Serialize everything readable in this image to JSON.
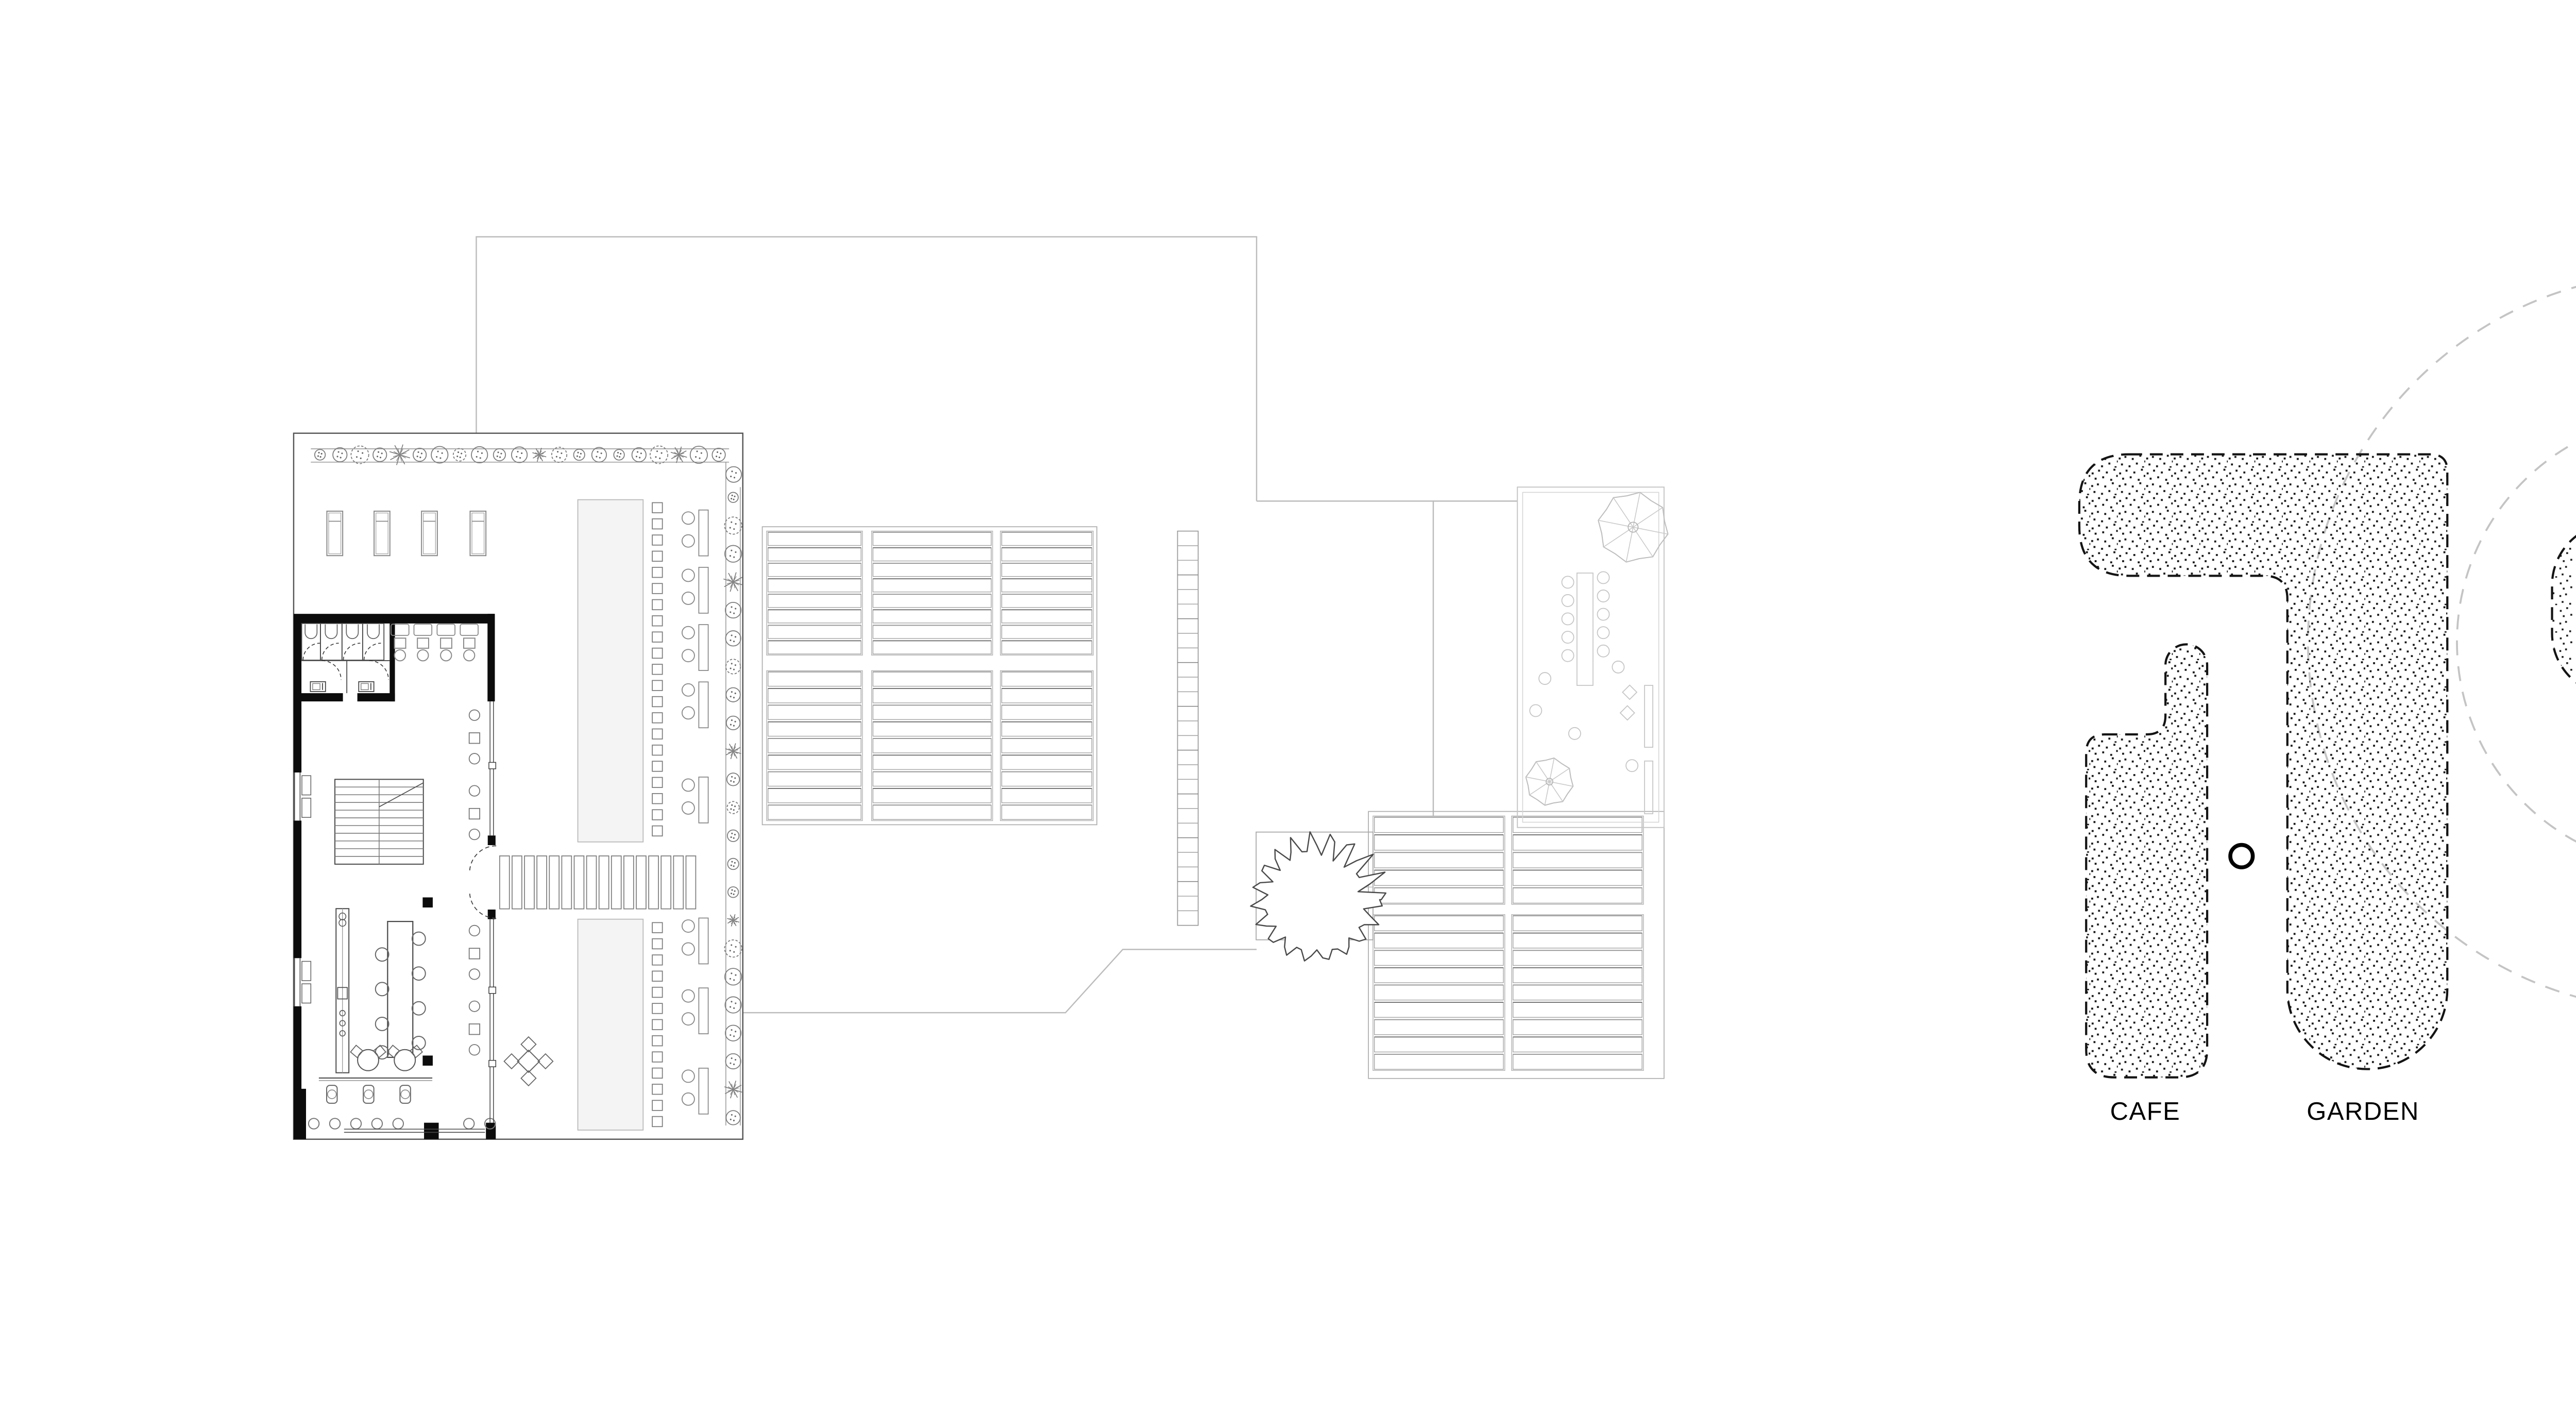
{
  "drawing": {
    "kind": "architectural plan and roof concept diagram",
    "background": "#ffffff",
    "ink": "#141414",
    "faint_line": "#bcbcbc",
    "mid_line": "#8f8f8f",
    "dashed_circle_color": "#c4c4c4",
    "planter_fill": "#f4f4f4"
  },
  "labels": {
    "cafe": "CAFE",
    "garden": "GARDEN",
    "skylight_center": "SKYLIGHT",
    "skylight_right": "SKYLIGHT"
  },
  "diagram_areas": [
    {
      "name": "cafe",
      "label": "CAFE",
      "texture": "stipple",
      "outline": "dashed"
    },
    {
      "name": "garden",
      "label": "GARDEN",
      "texture": "stipple",
      "outline": "dashed"
    },
    {
      "name": "skylight-central",
      "label": "SKYLIGHT",
      "texture": "stipple",
      "outline": "dashed"
    },
    {
      "name": "skylight-right",
      "label": "SKYLIGHT",
      "texture": "stipple",
      "outline": "dashed"
    },
    {
      "name": "planter-strip",
      "label": "",
      "texture": "stipple",
      "outline": "dashed"
    }
  ]
}
